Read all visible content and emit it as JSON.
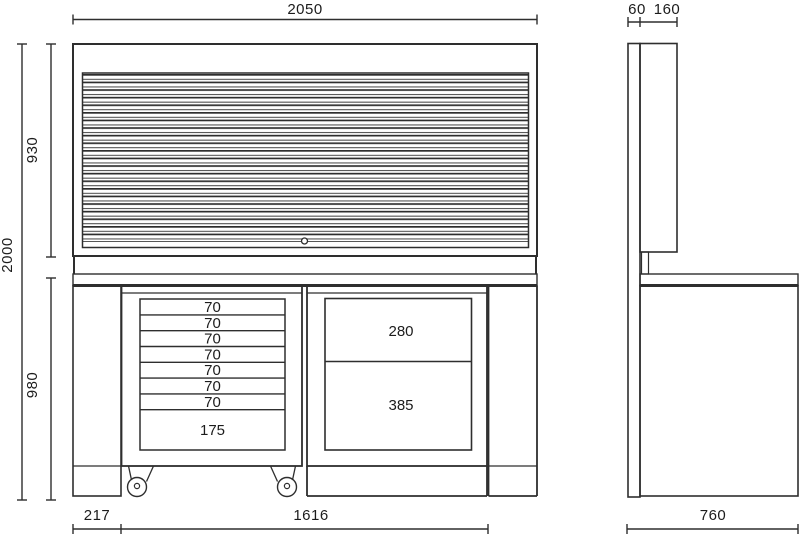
{
  "drawing": {
    "type": "technical-drawing",
    "subject": "workbench with roller-shutter cabinet, mobile drawer unit and fixed drawer unit",
    "views": [
      "front",
      "side"
    ]
  },
  "front_view": {
    "dimensions": {
      "total_width": "2050",
      "total_height": "2000",
      "upper_cabinet_height": "930",
      "bench_height": "980",
      "left_offset": "217",
      "bench_width": "1616"
    },
    "roller_cabinet": {
      "drawers": [
        "70",
        "70",
        "70",
        "70",
        "70",
        "70",
        "70",
        "175"
      ]
    },
    "fixed_cabinet": {
      "drawers": [
        "280",
        "385"
      ]
    }
  },
  "side_view": {
    "dimensions": {
      "back_panel_depth": "60",
      "upper_cabinet_depth": "160",
      "bench_depth": "760"
    }
  },
  "colors": {
    "line": "#2e2e2e",
    "background": "#ffffff",
    "text": "#1c1c1c"
  }
}
